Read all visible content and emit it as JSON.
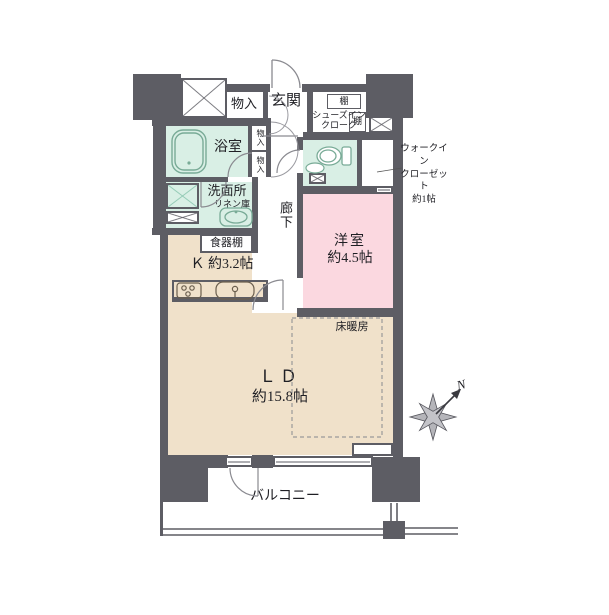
{
  "labels": {
    "storage_top": "物入",
    "entrance": "玄関",
    "shelf_top": "棚",
    "shelf_side": "棚",
    "shoes_cloak_line1": "シューズイン",
    "shoes_cloak_line2": "クローク",
    "bathroom": "浴室",
    "closet_cell_upper": "物入",
    "closet_cell_lower": "物入",
    "washroom": "洗面所",
    "linen_cabinet": "リネン庫",
    "corridor": "廊下",
    "wic_line1": "ウォークイン",
    "wic_line2": "クローゼット",
    "wic_line3": "約1帖",
    "cupboard": "食器棚",
    "kitchen": "Ｋ 約3.2帖",
    "western_room_name": "洋室",
    "western_room_size": "約4.5帖",
    "floor_heating": "床暖房",
    "living_dining_name": "ＬＤ",
    "living_dining_size": "約15.8帖",
    "balcony": "バルコニー",
    "compass_north": "N"
  },
  "colors": {
    "wall": "#5d5d64",
    "room_beige": "#f0e1ca",
    "room_pink": "#fbd8e0",
    "room_green": "#d9efe5",
    "hatch_teal": "#86c3ac",
    "line_gray": "#8a8a90"
  }
}
